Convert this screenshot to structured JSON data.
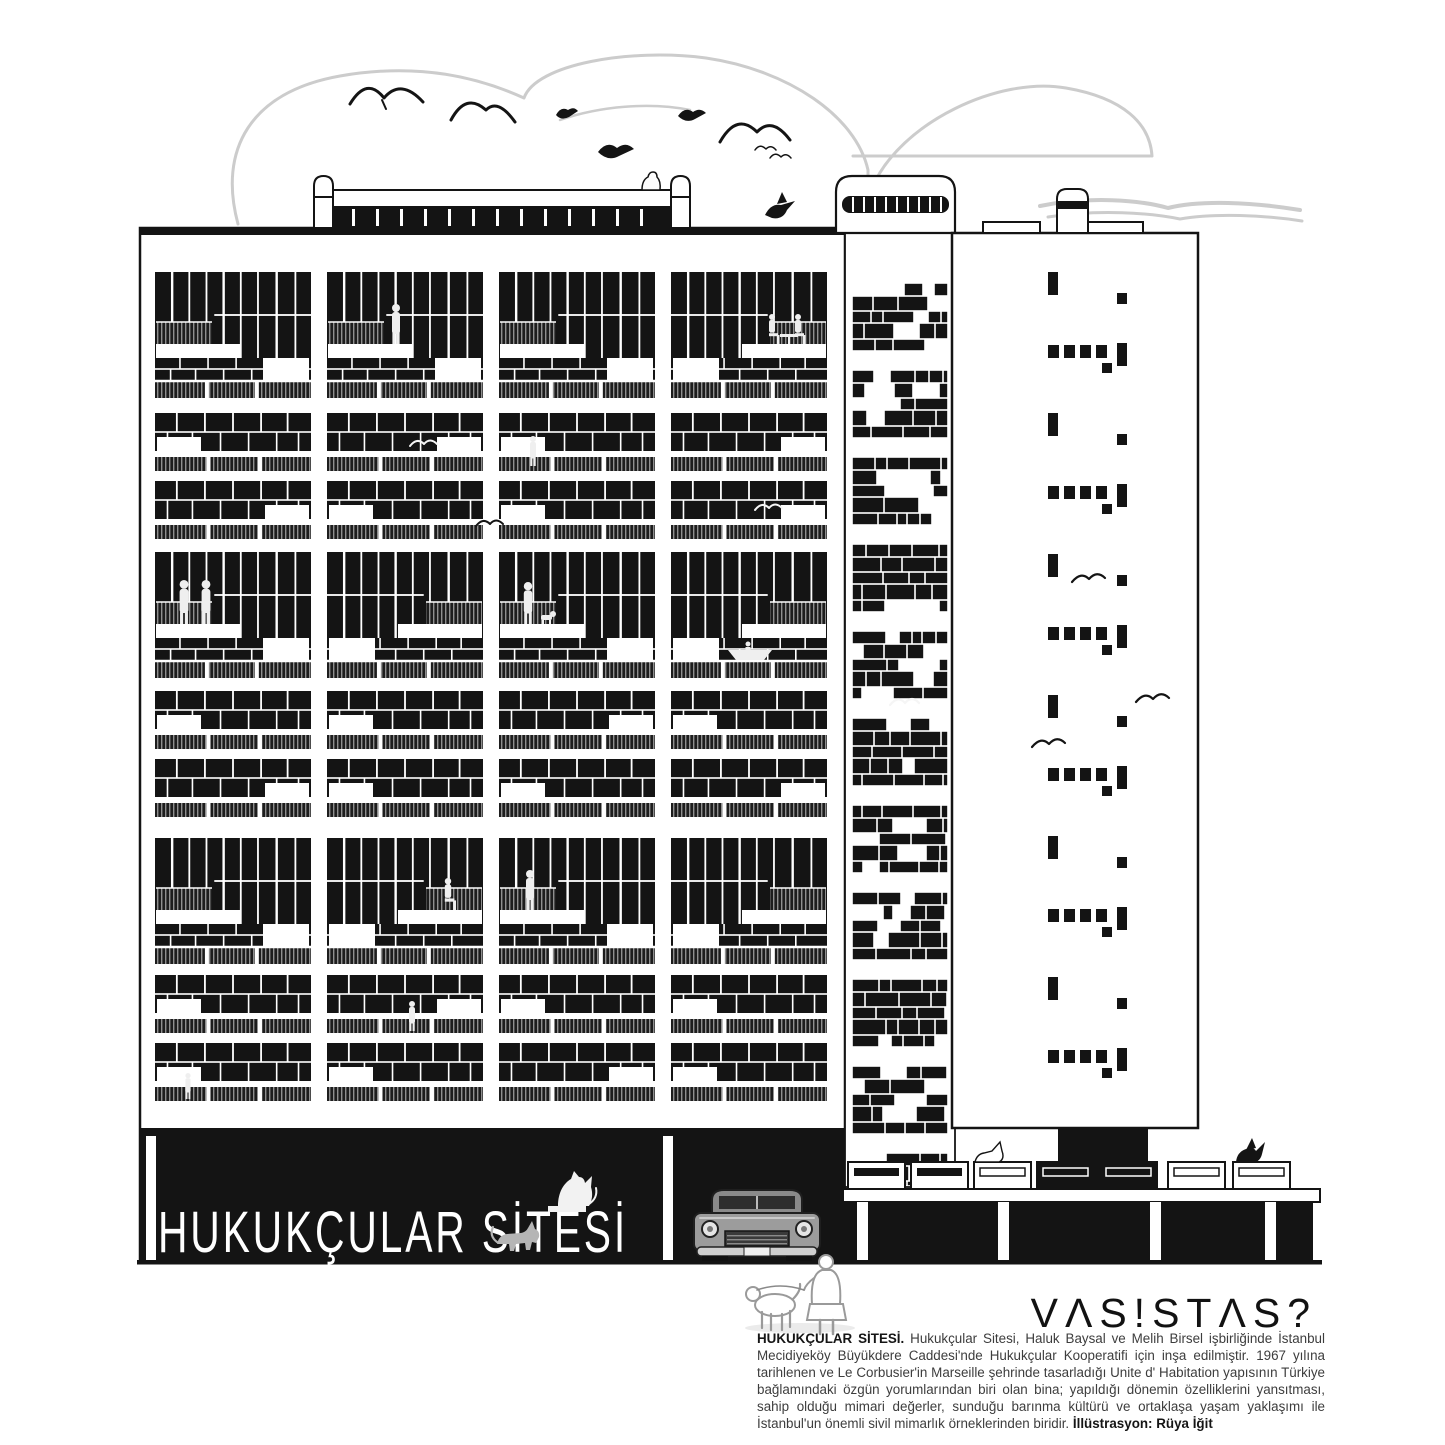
{
  "building_sign": {
    "text": "HUKUKÇULAR SİTESİ"
  },
  "brand": {
    "logo_text": "VΛS!STΛS?"
  },
  "caption": {
    "lead": "HUKUKÇULAR SİTESİ.",
    "body": "Hukukçular Sitesi, Haluk Baysal ve Melih Birsel işbirliğinde İstanbul Mecidiyeköy Büyükdere Caddesi'nde Hukukçular Kooperatifi için inşa edilmiştir. 1967 yılına tarihlenen ve Le Corbusier'in Marseille şehrinde tasarladığı Unite d' Habitation yapısının Türkiye bağlamındaki özgün yorumlarından biri olan bina; yapıldığı dönemin özelliklerini yansıtması, sahip olduğu mimari değerler, sunduğu barınma kültürü ve ortaklaşa yaşam yaklaşımı ile İstanbul'un önemli sivil mimarlık örneklerinden biridir.",
    "credit": "İllüstrasyon: Rüya İğit"
  },
  "colors": {
    "ink": "#141414",
    "cloud_gray": "#cccccc",
    "rail_gray": "#8f8f8f",
    "car_gray": "#9c9c9c"
  }
}
